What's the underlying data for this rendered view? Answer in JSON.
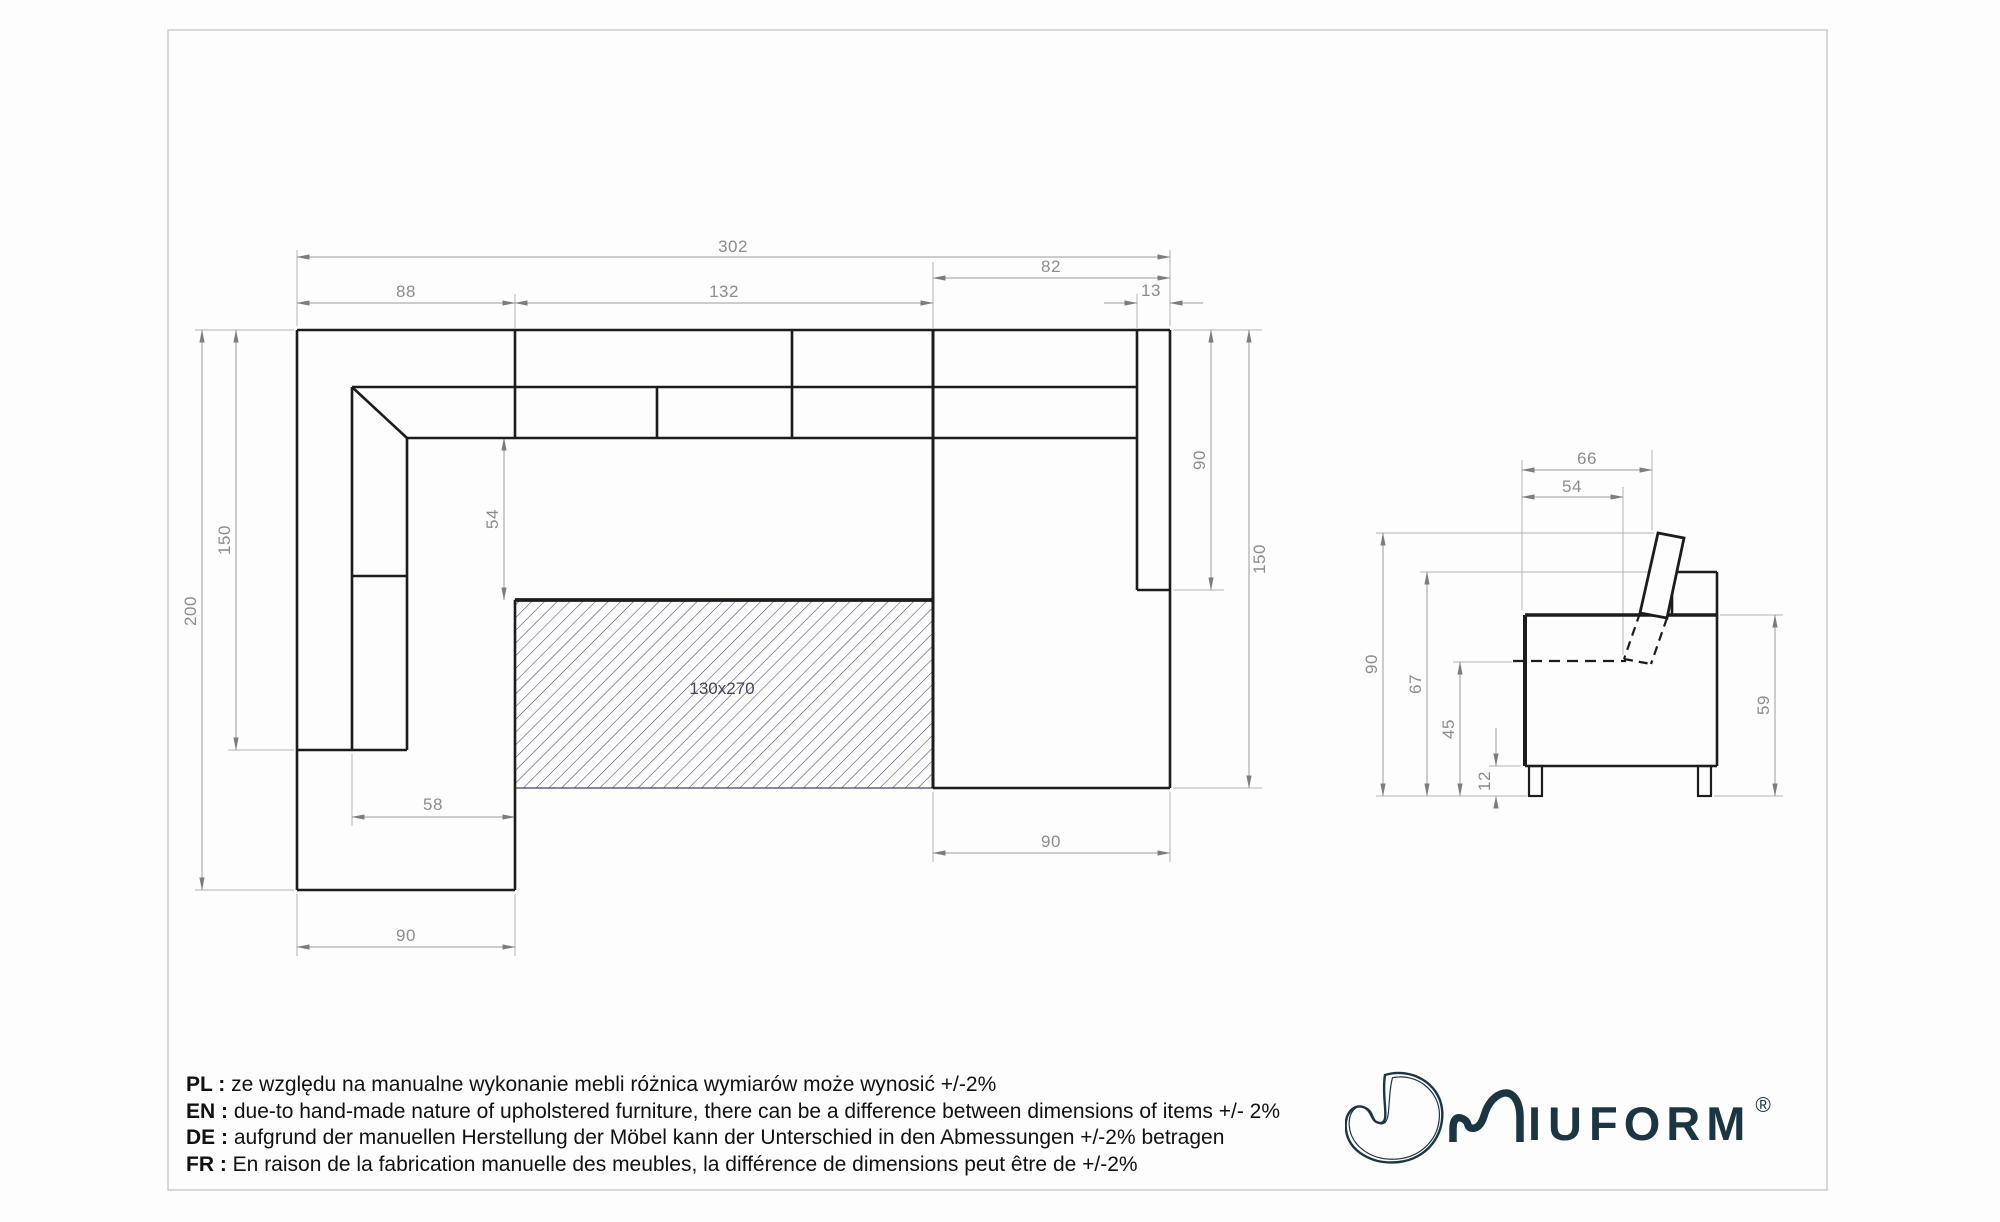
{
  "top_view": {
    "bed_label": "130x270",
    "dims": {
      "total_width": "302",
      "left_section": "88",
      "middle_section": "132",
      "right_section": "82",
      "right_armrest_width": "13",
      "left_inner_height": "150",
      "left_total_height": "200",
      "seat_depth": "54",
      "left_bed_offset": "58",
      "left_chaise_width": "90",
      "right_armrest_length": "90",
      "right_side_height": "150",
      "right_chaise_width": "90"
    }
  },
  "side_view": {
    "dims": {
      "total_depth": "66",
      "seat_depth": "54",
      "total_height": "90",
      "back_height": "67",
      "seat_height": "45",
      "leg_height": "12",
      "arm_height": "59"
    }
  },
  "notes": [
    {
      "label": "PL :",
      "text": "ze względu na manualne wykonanie mebli różnica wymiarów może wynosić +/-2%"
    },
    {
      "label": "EN :",
      "text": "due-to hand-made nature of upholstered furniture, there can be a difference between dimensions of items +/- 2%"
    },
    {
      "label": "DE :",
      "text": "aufgrund der manuellen Herstellung der Möbel kann der Unterschied in den Abmessungen +/-2% betragen"
    },
    {
      "label": "FR :",
      "text": "En raison de la fabrication manuelle des meubles, la différence de dimensions peut être de +/-2%"
    }
  ],
  "brand": {
    "letters_iu": "IU",
    "letters_form": "FORM",
    "registered": "®"
  },
  "colors": {
    "drawing_line": "#1c1c1c",
    "dimension_gray": "#8c8c8c",
    "logo_navy": "#1b3642",
    "hatch_navy": "#44446a",
    "page_border": "#cbcbcb"
  }
}
